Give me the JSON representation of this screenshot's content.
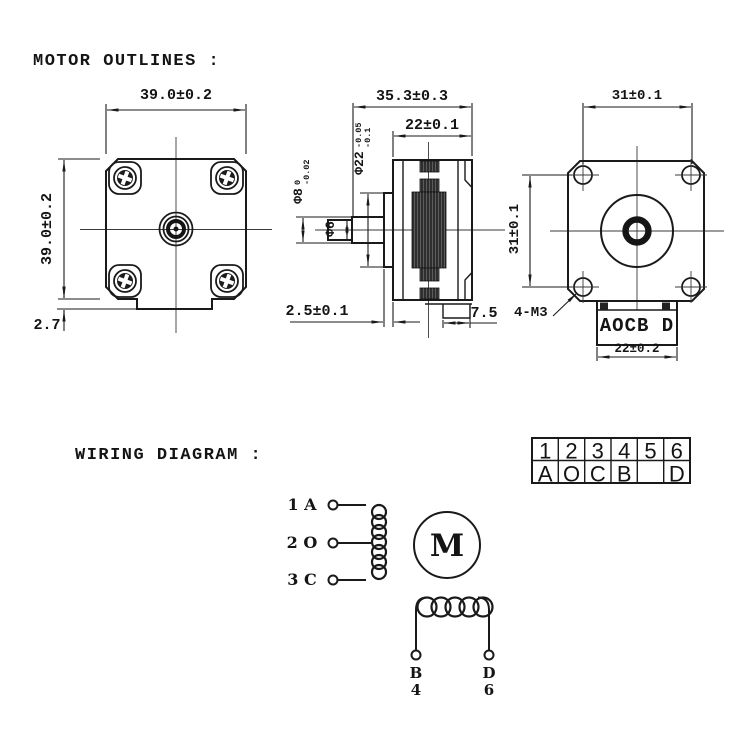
{
  "titles": {
    "outlines": "MOTOR OUTLINES :",
    "wiring": "WIRING DIAGRAM :"
  },
  "front_view": {
    "width": "39.0±0.2",
    "height": "39.0±0.2",
    "bottom_step": "2.7"
  },
  "side_view": {
    "total_length": "35.3±0.3",
    "body_length": "22±0.1",
    "shaft_dia": "Φ8",
    "shaft_dia_tol_top": "0",
    "shaft_dia_tol_bottom": "-0.02",
    "shaft_tip_dia": "Φ6",
    "pilot_dia": "Φ22",
    "pilot_dia_tol_top": "-0.05",
    "pilot_dia_tol_bottom": "-0.1",
    "pilot_height": "2.5±0.1",
    "connector_depth": "7.5"
  },
  "back_view": {
    "hole_spacing_horizontal": "31±0.1",
    "hole_spacing_vertical": "31±0.1",
    "mounting_holes": "4-M3",
    "connector_pins": "AOCB D",
    "connector_width": "22±0.2"
  },
  "pin_table": {
    "pins": [
      "1",
      "2",
      "3",
      "4",
      "5",
      "6"
    ],
    "signals": [
      "A",
      "O",
      "C",
      "B",
      "",
      "D"
    ]
  },
  "wiring": {
    "terminals": [
      "1 A",
      "2 O",
      "3 C"
    ],
    "motor": "M",
    "lead_left_letter": "B",
    "lead_left_number": "4",
    "lead_right_letter": "D",
    "lead_right_number": "6"
  },
  "colors": {
    "line": "#1a1a1a",
    "background": "#ffffff"
  }
}
